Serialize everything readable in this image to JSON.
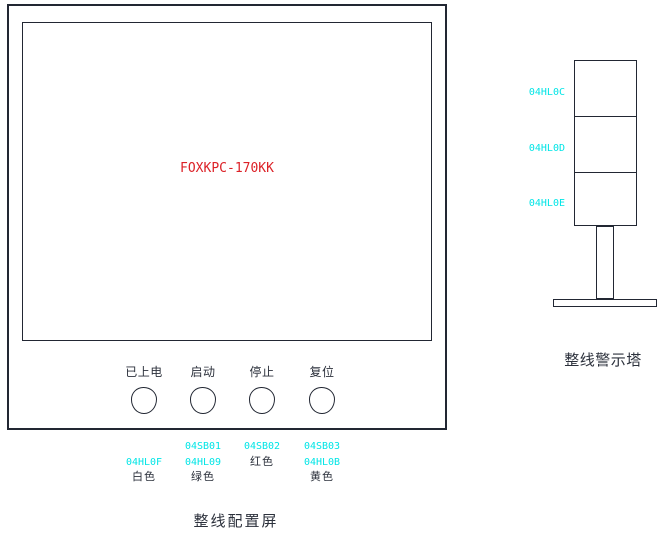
{
  "colors": {
    "line": "#222733",
    "cyan": "#00e5e6",
    "red": "#dc2127",
    "dark_text": "#2c313c"
  },
  "monitor": {
    "screen_model": "FOXKPC-170KK",
    "caption": "整线配置屏"
  },
  "buttons": [
    {
      "label": "已上电",
      "tag_row2": "04HL0F",
      "color_name": "白色"
    },
    {
      "label": "启动",
      "tag_row1": "04SB01",
      "tag_row2": "04HL09",
      "color_name": "绿色"
    },
    {
      "label": "停止",
      "tag_row1": "04SB02",
      "color_name": "红色"
    },
    {
      "label": "复位",
      "tag_row1": "04SB03",
      "tag_row2": "04HL0B",
      "color_name": "黄色"
    }
  ],
  "tower": {
    "caption": "整线警示塔",
    "segments": [
      {
        "tag": "04HL0C"
      },
      {
        "tag": "04HL0D"
      },
      {
        "tag": "04HL0E"
      }
    ]
  }
}
